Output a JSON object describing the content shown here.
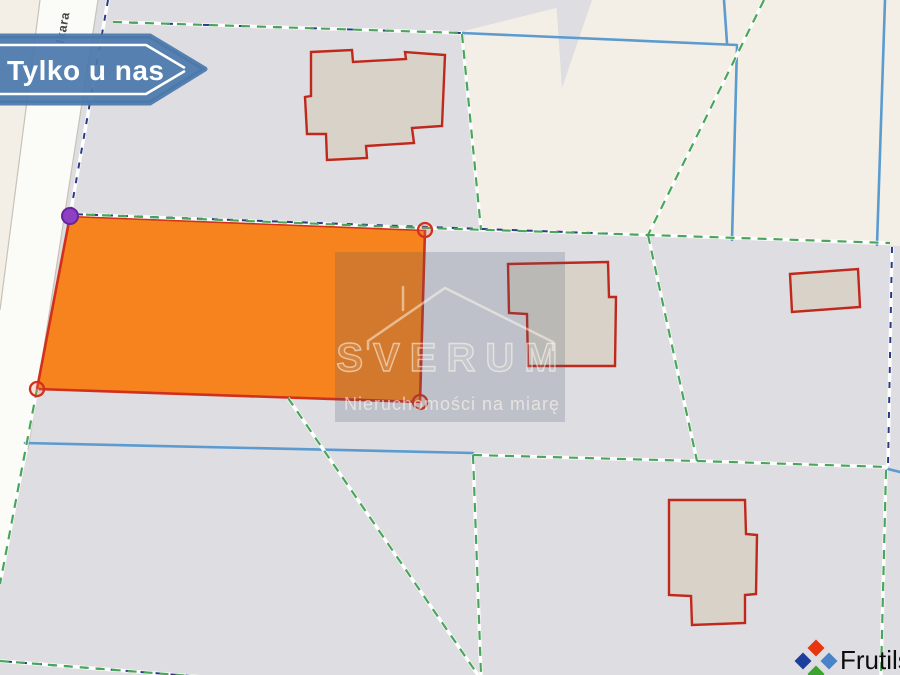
{
  "banner": {
    "label": "Tylko u nas",
    "color": "#4a79ab"
  },
  "street": {
    "label": "Ikara"
  },
  "watermark": {
    "brand": "SVERUM",
    "tagline": "Nieruchomości na miarę"
  },
  "logo": {
    "brand": "Frutils",
    "colors": {
      "top": "#e8350e",
      "left": "#1e3e9e",
      "right": "#4b83c8",
      "bottom": "#3ba32f"
    }
  },
  "map_colors": {
    "highlighted_parcel_fill": "#f6831d",
    "highlighted_parcel_border": "#d0301c",
    "vertex_marker_purple": "#8f3fc4",
    "parcel_boundary_green": "#4aa55c",
    "admin_boundary_navy": "#2c3a85",
    "line_blue": "#5b9bd0",
    "building_outline_red": "#c0281c",
    "building_fill": "#d9d2c9",
    "parcel_gray": "#dedde1",
    "background_cream": "#f3efe6",
    "road_white": "#fbfbf8"
  }
}
